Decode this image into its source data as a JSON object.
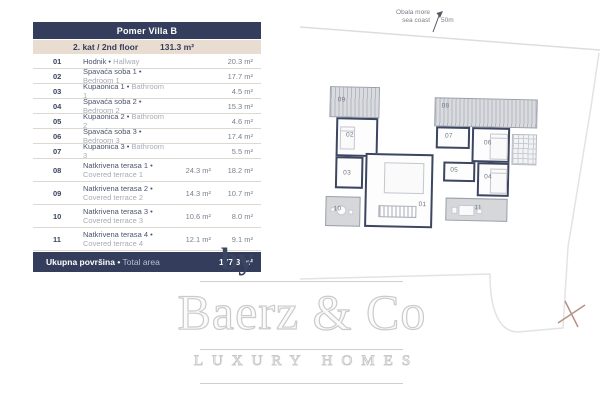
{
  "table": {
    "title": "Pomer Villa B",
    "floor_label": "2. kat / 2nd floor",
    "floor_area": "131.3 m²",
    "rows": [
      {
        "num": "01",
        "hr": "Hodnik •",
        "en": "Hallway",
        "gross": "",
        "net": "20.3 m²"
      },
      {
        "num": "02",
        "hr": "Spavaća soba 1 •",
        "en": "Bedroom 1",
        "gross": "",
        "net": "17.7 m²"
      },
      {
        "num": "03",
        "hr": "Kupaonica 1 •",
        "en": "Bathroom 1",
        "gross": "",
        "net": "4.5 m²"
      },
      {
        "num": "04",
        "hr": "Spavaća soba 2 •",
        "en": "Bedroom 2",
        "gross": "",
        "net": "15.3 m²"
      },
      {
        "num": "05",
        "hr": "Kupaonica 2 •",
        "en": "Bathroom 2",
        "gross": "",
        "net": "4.6 m²"
      },
      {
        "num": "06",
        "hr": "Spavaća soba 3 •",
        "en": "Bedroom 3",
        "gross": "",
        "net": "17.4 m²"
      },
      {
        "num": "07",
        "hr": "Kupaonica 3 •",
        "en": "Bathroom 3",
        "gross": "",
        "net": "5.5 m²"
      },
      {
        "num": "08",
        "hr": "Natkrivena terasa 1 •",
        "en": "Covered terrace 1",
        "gross": "24.3 m²",
        "net": "18.2 m²"
      },
      {
        "num": "09",
        "hr": "Natkrivena terasa 2 •",
        "en": "Covered terrace 2",
        "gross": "14.3 m²",
        "net": "10.7 m²"
      },
      {
        "num": "10",
        "hr": "Natkrivena terasa 3 •",
        "en": "Covered terrace 3",
        "gross": "10.6 m²",
        "net": "8.0 m²"
      },
      {
        "num": "11",
        "hr": "Natkrivena terasa 4 •",
        "en": "Covered terrace 4",
        "gross": "12.1 m²",
        "net": "9.1 m²"
      }
    ],
    "total_label_hr": "Ukupna površina •",
    "total_label_en": " Total area",
    "total_area": "177.3 m²"
  },
  "plan": {
    "compass": {
      "line1": "Obala more",
      "line2": "sea coast",
      "distance": "50m"
    },
    "labels": {
      "r01": "01",
      "r02": "02",
      "r03": "03",
      "r04": "04",
      "r05": "05",
      "r06": "06",
      "r07": "07",
      "r08": "08",
      "r09": "09",
      "r10": "10",
      "r11": "11"
    }
  },
  "watermark": {
    "by": "by",
    "brand": "Baerz & Co",
    "tagline": "LUXURY HOMES"
  },
  "colors": {
    "header_navy": "#343e5c",
    "header_beige": "#e9ddd1",
    "wall_navy": "#3c4660",
    "watermark_gray": "#cbcbcb",
    "marker_brown": "#b59285"
  }
}
